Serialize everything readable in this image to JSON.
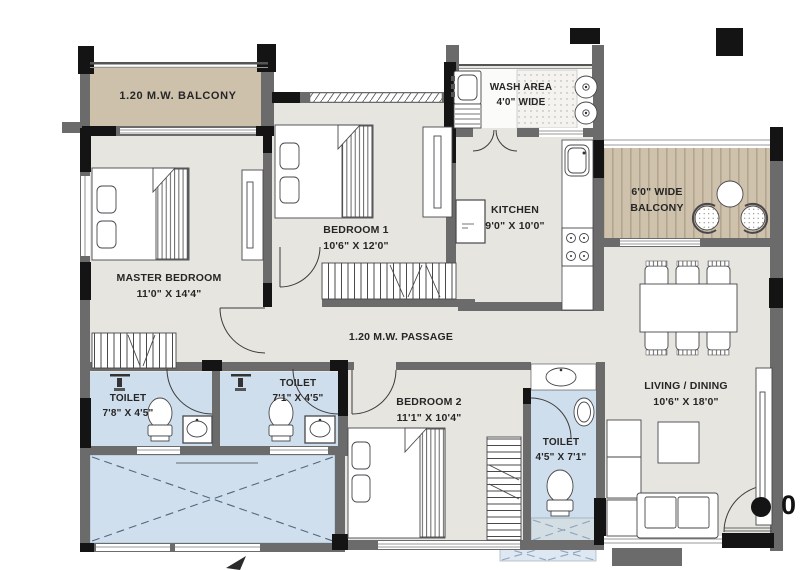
{
  "rooms": [
    {
      "id": "balcony-top",
      "line1": "1.20 M.W. BALCONY",
      "line2": ""
    },
    {
      "id": "master-bedroom",
      "line1": "MASTER BEDROOM",
      "line2": "11'0\" X 14'4\""
    },
    {
      "id": "bedroom-1",
      "line1": "BEDROOM 1",
      "line2": "10'6\" X 12'0\""
    },
    {
      "id": "wash-area",
      "line1": "WASH AREA",
      "line2": "4'0\" WIDE"
    },
    {
      "id": "kitchen",
      "line1": "KITCHEN",
      "line2": "9'0\" X 10'0\""
    },
    {
      "id": "balcony-right",
      "line1": "6'0\" WIDE",
      "line2": "BALCONY"
    },
    {
      "id": "living-dining",
      "line1": "LIVING / DINING",
      "line2": "10'6\" X 18'0\""
    },
    {
      "id": "passage",
      "line1": "1.20 M.W. PASSAGE",
      "line2": ""
    },
    {
      "id": "toilet-1",
      "line1": "TOILET",
      "line2": "7'8\" X 4'5\""
    },
    {
      "id": "toilet-2",
      "line1": "TOILET",
      "line2": "7'1\" X 4'5\""
    },
    {
      "id": "bedroom-2",
      "line1": "BEDROOM 2",
      "line2": "11'1\" X 10'4\""
    },
    {
      "id": "toilet-3",
      "line1": "TOILET",
      "line2": "4'5\" X 7'1\""
    }
  ],
  "annotations": {
    "unit_number_partial": "0"
  },
  "colors": {
    "wall": "#6b6b6b",
    "column": "#141414",
    "floor": "#e6e5e0",
    "balcony_deck": "#cdc1ab",
    "wood_deck": "#cfc2ac",
    "toilet_floor": "#cfdeec",
    "duct": "#c3d7e9",
    "line": "#47474b"
  }
}
